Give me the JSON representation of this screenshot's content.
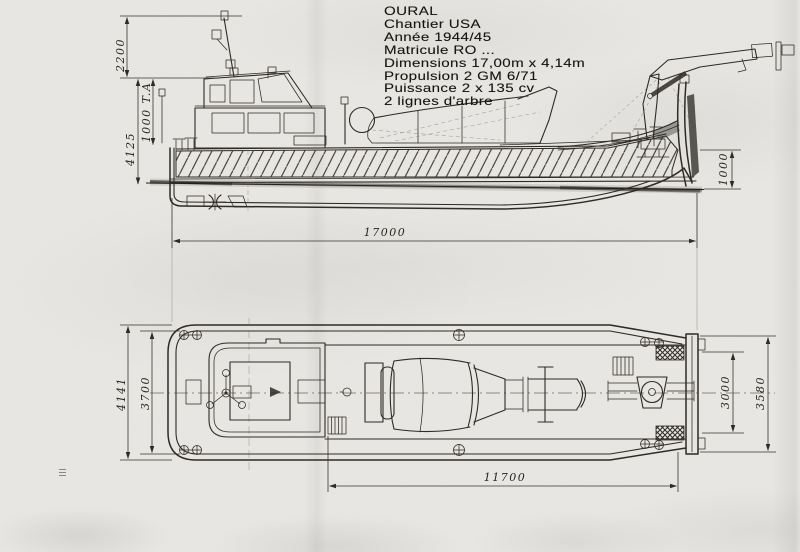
{
  "spec": {
    "lines": [
      "OURAL",
      "Chantier USA",
      "Année 1944/45",
      "Matricule  RO ...",
      "Dimensions 17,00m x 4,14m",
      "Propulsion 2 GM 6/71",
      "Puissance 2 x 135 cv",
      "2 lignes d'arbre"
    ]
  },
  "side_view": {
    "dims": {
      "mast_height": "2200",
      "air_draft": "1000 T.A",
      "hull_height": "4125",
      "bow_freeboard": "1000",
      "length_overall": "17000"
    }
  },
  "plan_view": {
    "dims": {
      "beam_overall": "4141",
      "beam_deck": "3700",
      "bow_width_inner": "3000",
      "bow_width_outer": "3580",
      "well_length": "11700"
    }
  },
  "colors": {
    "ink": "#2b2722",
    "paper": "#e9e7e3"
  }
}
